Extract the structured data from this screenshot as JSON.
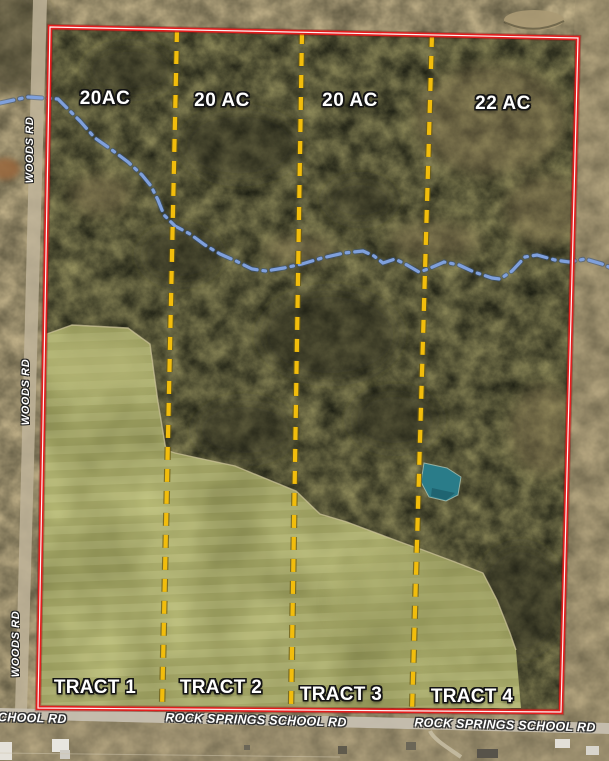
{
  "map": {
    "description": "Aerial real-estate tract map of a rural property divided into four tracts",
    "tracts": [
      {
        "name": "TRACT 1",
        "acreage": "20AC"
      },
      {
        "name": "TRACT 2",
        "acreage": "20 AC"
      },
      {
        "name": "TRACT 3",
        "acreage": "20 AC"
      },
      {
        "name": "TRACT 4",
        "acreage": "22 AC"
      }
    ],
    "road_labels": {
      "left_road": [
        {
          "text": "WOODS RD"
        },
        {
          "text": "WOODS RD"
        },
        {
          "text": "WOODS RD"
        }
      ],
      "bottom_road": [
        {
          "text": "SCHOOL RD"
        },
        {
          "text": "ROCK SPRINGS SCHOOL RD"
        },
        {
          "text": "ROCK SPRINGS SCHOOL RD"
        }
      ]
    },
    "colors": {
      "boundary": "#e31d1d",
      "boundary_core": "#ffffff",
      "divider": "#f2bd0c",
      "divider_edge": "#6b5a10",
      "creek": "#7fa0dc",
      "creek_edge": "#2f4f86",
      "pond": "#2a7c89",
      "field": "#a6a868",
      "woods": "#4c4834",
      "road_surface": "#c2b89f"
    }
  }
}
